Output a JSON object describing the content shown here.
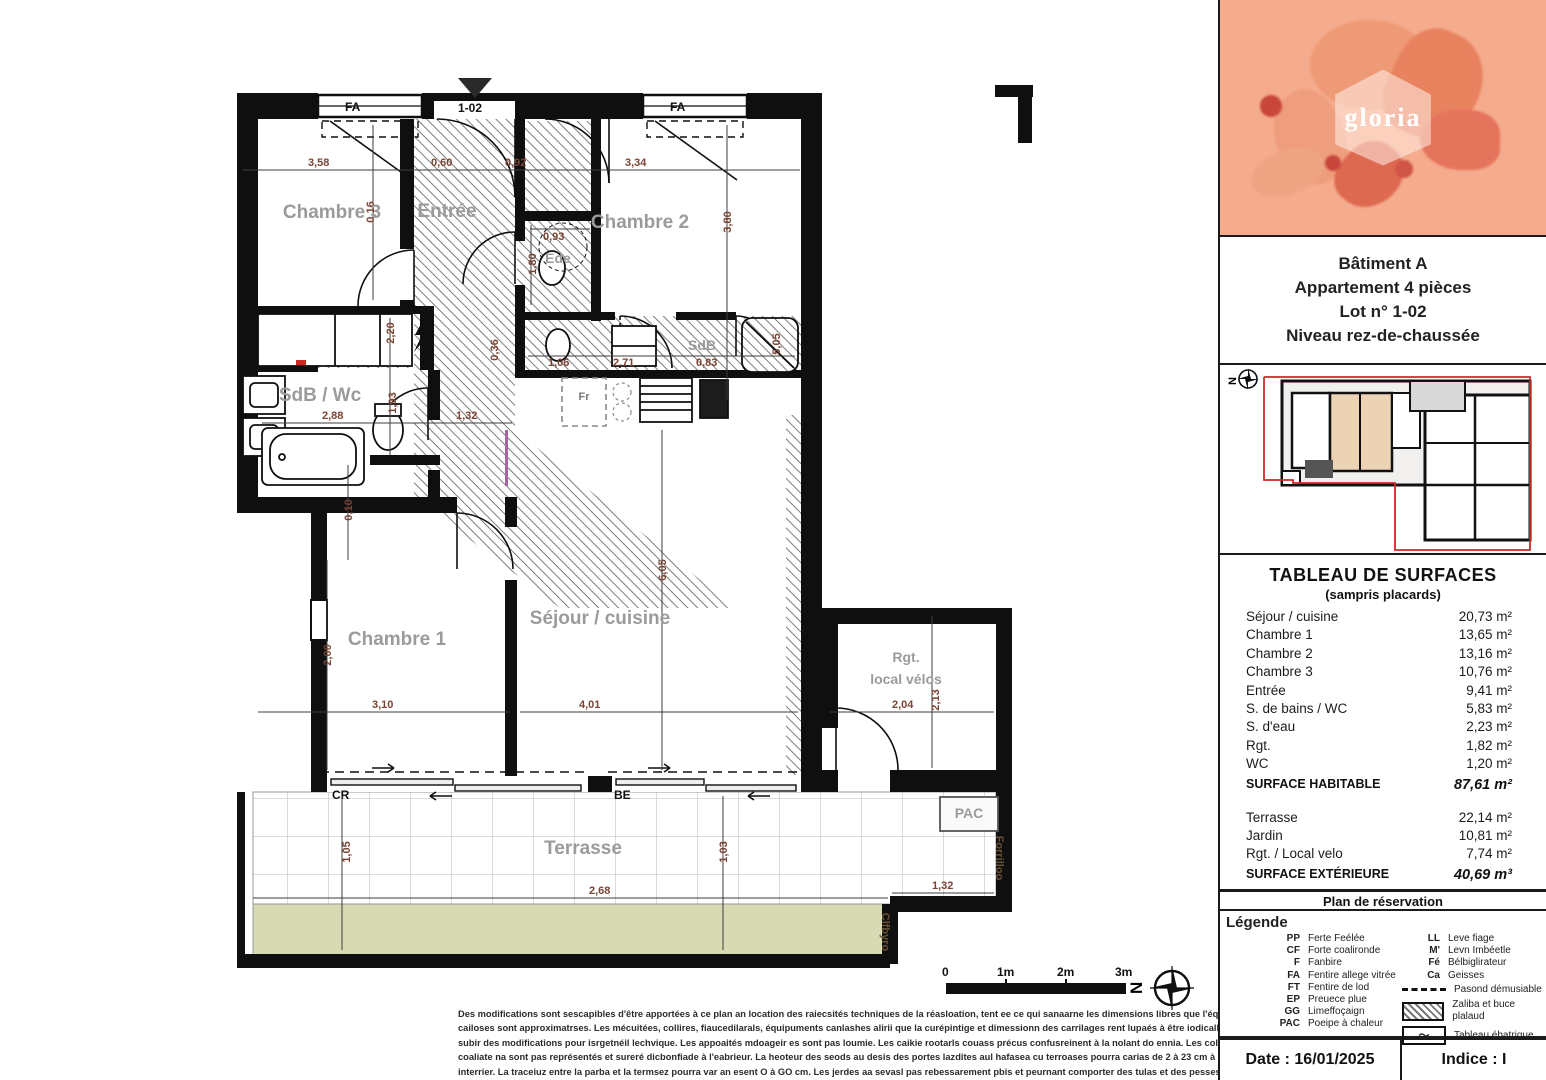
{
  "colors": {
    "wall": "#0f0f0f",
    "dim_text": "#7a4434",
    "room_label": "#9b9b9b",
    "garden": "#d7dab3",
    "logo_background": "#f5ab8d",
    "keyplan_unit_fill": "#ecd3b4",
    "keyplan_boundary_red": "#cc2a2a"
  },
  "plan": {
    "entrance_label": "1-02",
    "labels": {
      "chambre3": "Chambre 3",
      "entree": "Entrée",
      "chambre2": "Chambre 2",
      "ede_room": "Ede",
      "sdb_strip": "SdB",
      "sdb_wc": "SdB / Wc",
      "chambre1": "Chambre 1",
      "sejour": "Séjour / cuisine",
      "rgt_line1": "Rgt.",
      "rgt_line2": "local vélos",
      "terrasse": "Terrasse",
      "pac": "PAC",
      "fr": "Fr",
      "window_fa_left": "FA",
      "window_fa_right": "FA",
      "door_cr": "CR",
      "door_be": "BE",
      "right_vertical": "Forrilloo",
      "garden_vertical": "Clfbyro",
      "north": "N"
    },
    "dims": {
      "t1": "3,58",
      "t2": "0,60",
      "t3": "0,92",
      "t4": "3,34",
      "v_016": "0,16",
      "v_380": "3,80",
      "v_220": "2,20",
      "v_193": "1,93",
      "h_288": "2,88",
      "h_132": "1,32",
      "v_010": "0,10",
      "h_093": "0,93",
      "v_180": "1,80",
      "v_036": "0,36",
      "h_106": "1,06",
      "h_271": "2,71",
      "h_083": "0,83",
      "v_505": "5,05",
      "v_605": "6,05",
      "v_200": "2,00",
      "h_310": "3,10",
      "h_401": "4,01",
      "h_204": "2,04",
      "v_213": "2,13",
      "v_105": "1,05",
      "v_103": "1,03",
      "h_268": "2,68",
      "b_132": "1,32"
    }
  },
  "scale_bar": {
    "t0": "0",
    "t1": "1m",
    "t2": "2m",
    "t3": "3m"
  },
  "keyplan": {
    "north": "N"
  },
  "sidebar": {
    "logo": {
      "brand": "gloria"
    },
    "header": {
      "building": "Bâtiment A",
      "apartment": "Appartement 4 pièces",
      "lot": "Lot n° 1-02",
      "level": "Niveau rez-de-chaussée"
    },
    "surface_table": {
      "title": "TABLEAU DE SURFACES",
      "subtitle": "(sampris placards)",
      "rows": [
        {
          "label": "Séjour / cuisine",
          "value": "20,73  m²"
        },
        {
          "label": "Chambre 1",
          "value": "13,65  m²"
        },
        {
          "label": "Chambre 2",
          "value": "13,16  m²"
        },
        {
          "label": "Chambre 3",
          "value": "10,76  m²"
        },
        {
          "label": "Entrée",
          "value": "9,41  m²"
        },
        {
          "label": "S. de bains / WC",
          "value": "5,83  m²"
        },
        {
          "label": "S. d'eau",
          "value": "2,23  m²"
        },
        {
          "label": "Rgt.",
          "value": "1,82  m²"
        },
        {
          "label": "WC",
          "value": "1,20  m²"
        }
      ],
      "total_label": "SURFACE HABITABLE",
      "total_value": "87,61 m²",
      "ext_rows": [
        {
          "label": "Terrasse",
          "value": "22,14  m²"
        },
        {
          "label": "Jardin",
          "value": "10,81  m²"
        },
        {
          "label": "Rgt. /  Local velo",
          "value": "7,74  m²"
        }
      ],
      "ext_total_label": "SURFACE EXTÉRIEURE",
      "ext_total_value": "40,69 m³"
    },
    "reservation_title": "Plan de réservation",
    "legend": {
      "title": "Légende",
      "left": [
        {
          "abbr": "PP",
          "label": "Ferte Feélée"
        },
        {
          "abbr": "CF",
          "label": "Forte coalironde"
        },
        {
          "abbr": "F",
          "label": "Fanbire"
        },
        {
          "abbr": "FA",
          "label": "Fentire allege vitrée"
        },
        {
          "abbr": "FT",
          "label": "Fentire de lod"
        },
        {
          "abbr": "EP",
          "label": "Preuece plue"
        },
        {
          "abbr": "GG",
          "label": "Limeffoçaign"
        },
        {
          "abbr": "PAC",
          "label": "Poeipe à chaleur"
        }
      ],
      "right": [
        {
          "abbr": "LL",
          "label": "Leve fiage"
        },
        {
          "abbr": "M'",
          "label": "Levn Imbéetle"
        },
        {
          "abbr": "Fé",
          "label": "Bélbiglirateur"
        },
        {
          "abbr": "Ca",
          "label": "Geisses"
        }
      ],
      "symbols": [
        {
          "type": "dashed-line",
          "label": "Pasond démusiable"
        },
        {
          "type": "hatch-box",
          "label": "Zaliba et buce plalaud"
        },
        {
          "type": "zigzag-box",
          "label": "Tableau ébatrique"
        }
      ]
    },
    "date_label": "Date : 16/01/2025",
    "indice_label": "Indice : I"
  },
  "footer": {
    "line1": "Des modifications sont sescapibles d'être apportées à ce plan an location des raiecsités techniques de la réasloation, tent ee ce qui sanaarne les dimensions libres que l'équipament. Les",
    "line2": "cailoses sont approximatrses. Les mécuitées, collires, fiaucedilarals, équipuments canlashes alirii que la curépintige et dimessionn des carrilages rent lupaés à être iodicalli et pevesail",
    "line3": "subir des modifications pour isrgetnéil lechvique. Les appoaités mdoageir es sont pas loumie. Les caikie rootarls couass précus confusreinent à la nolant do ennia. Les colkies de valets",
    "line4": "coaliate na sont pas représentés et sureré dicbonfiade à l'eabrieur. La heoteur des seods au desis des portes lazdites aul hafasea cu terroases pourra carias de 2 à 23 cm à parta de cal",
    "line5": "interrier. La traceiuz entre la parba et la termsez pourra var an esent O à GO cm. Les jerdes aa sevasl pas rebessarement pbis et peurnant comporter des tulas et des pesses."
  }
}
